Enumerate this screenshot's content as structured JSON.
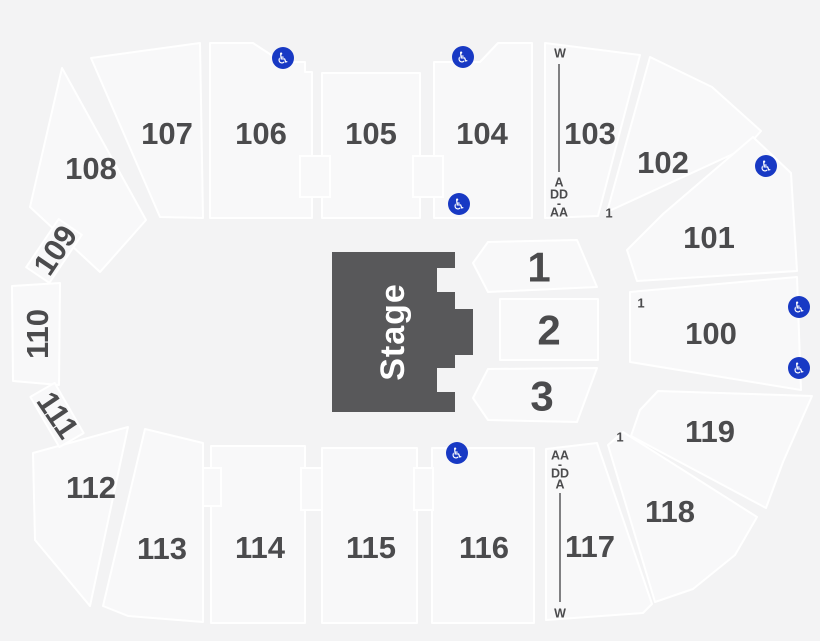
{
  "stage": {
    "label": "Stage"
  },
  "sections": {
    "100": "100",
    "101": "101",
    "102": "102",
    "103": "103",
    "104": "104",
    "105": "105",
    "106": "106",
    "107": "107",
    "108": "108",
    "109": "109",
    "110": "110",
    "111": "111",
    "112": "112",
    "113": "113",
    "114": "114",
    "115": "115",
    "116": "116",
    "117": "117",
    "118": "118",
    "119": "119"
  },
  "floor": {
    "1": "1",
    "2": "2",
    "3": "3"
  },
  "rows_top": {
    "w": "W",
    "a": "A",
    "dd": "DD",
    "dash": "-",
    "aa": "AA"
  },
  "rows_bottom": {
    "aa": "AA",
    "dash": "-",
    "dd": "DD",
    "a": "A",
    "w": "W"
  },
  "entrances": {
    "e1": "1",
    "e2": "1",
    "e3": "1"
  },
  "accessible": {
    "symbol": "♿"
  },
  "colors": {
    "background": "#f3f3f4",
    "section_fill": "#f8f8f9",
    "section_stroke": "#ffffff",
    "label": "#4b4b4d",
    "stage_fill": "#58585a",
    "accessible_blue": "#1839c4"
  }
}
